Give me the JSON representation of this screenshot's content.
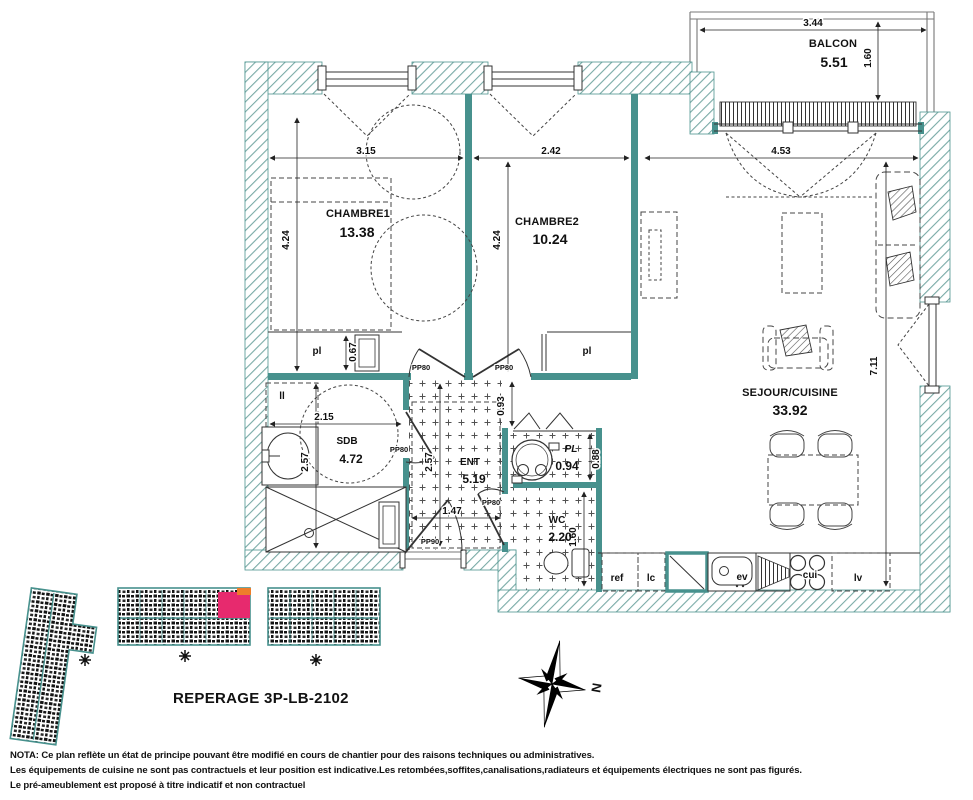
{
  "colors": {
    "teal": "#47918d",
    "pink": "#e72a6e",
    "orange": "#ee7d2a"
  },
  "balcony": {
    "name": "BALCON",
    "area": "5.51",
    "width": "3.44",
    "depth": "1.60"
  },
  "chambre1": {
    "name": "CHAMBRE1",
    "area": "13.38",
    "width": "3.15",
    "height": "4.24",
    "closet": "pl",
    "closet_depth": "0.67"
  },
  "chambre2": {
    "name": "CHAMBRE2",
    "area": "10.24",
    "width": "2.42",
    "height": "4.24",
    "closet": "pl"
  },
  "sejour": {
    "name": "SEJOUR/CUISINE",
    "area": "33.92",
    "width": "4.53",
    "height": "7.11"
  },
  "sdb": {
    "name": "SDB",
    "area": "4.72",
    "width": "2.15",
    "height": "2.57",
    "washer": "ll"
  },
  "ent": {
    "name": "ENT",
    "area": "5.19",
    "height": "2.57",
    "width": "1.47",
    "offset": "0.93"
  },
  "pl": {
    "name": "PL",
    "area": "0.94",
    "height": "0.88"
  },
  "wc": {
    "name": "WC",
    "area": "2.20",
    "height": "1.60"
  },
  "kitchen": {
    "fridge": "ref",
    "cupboard": "lc",
    "sink": "ev",
    "hob": "cui",
    "dishwasher": "lv"
  },
  "doors": {
    "interior": "PP80",
    "entrance": "PP90"
  },
  "compass": {
    "north": "N"
  },
  "reperage": {
    "title": "REPERAGE 3P-LB-2102"
  },
  "nota": {
    "line1": "NOTA: Ce plan reflète un état de principe pouvant être modifié en cours de chantier pour des raisons techniques ou administratives.",
    "line2": "Les équipements de cuisine ne sont pas contractuels et leur position est indicative.Les retombées,soffites,canalisations,radiateurs et équipements électriques ne sont pas figurés.",
    "line3": "Le pré-ameublement est proposé à titre indicatif et non contractuel"
  }
}
